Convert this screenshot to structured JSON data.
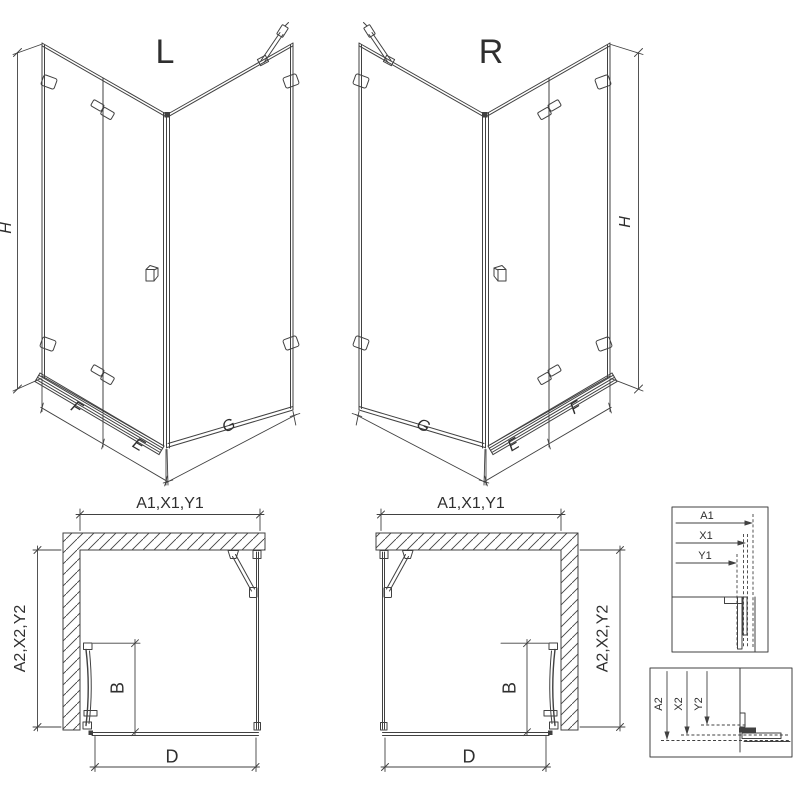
{
  "drawing": {
    "iso_l": {
      "variant_label": "L",
      "height_label": "H",
      "fixed_panel_label": "F",
      "door_label": "E",
      "side_panel_label": "G"
    },
    "iso_r": {
      "variant_label": "R",
      "height_label": "H",
      "fixed_panel_label": "F",
      "door_label": "E",
      "side_panel_label": "G"
    },
    "plan_l": {
      "width_label": "A1,X1,Y1",
      "depth_label": "A2,X2,Y2",
      "door_width_label": "B",
      "opening_label": "D"
    },
    "plan_r": {
      "width_label": "A1,X1,Y1",
      "depth_label": "A2,X2,Y2",
      "door_width_label": "B",
      "opening_label": "D"
    },
    "detail_width_offsets": {
      "labels": [
        "A1",
        "X1",
        "Y1"
      ]
    },
    "detail_depth_offsets": {
      "labels": [
        "A2",
        "X2",
        "Y2"
      ]
    },
    "colors": {
      "line": "#414141",
      "text": "#2f2f2f",
      "background": "#ffffff"
    }
  }
}
